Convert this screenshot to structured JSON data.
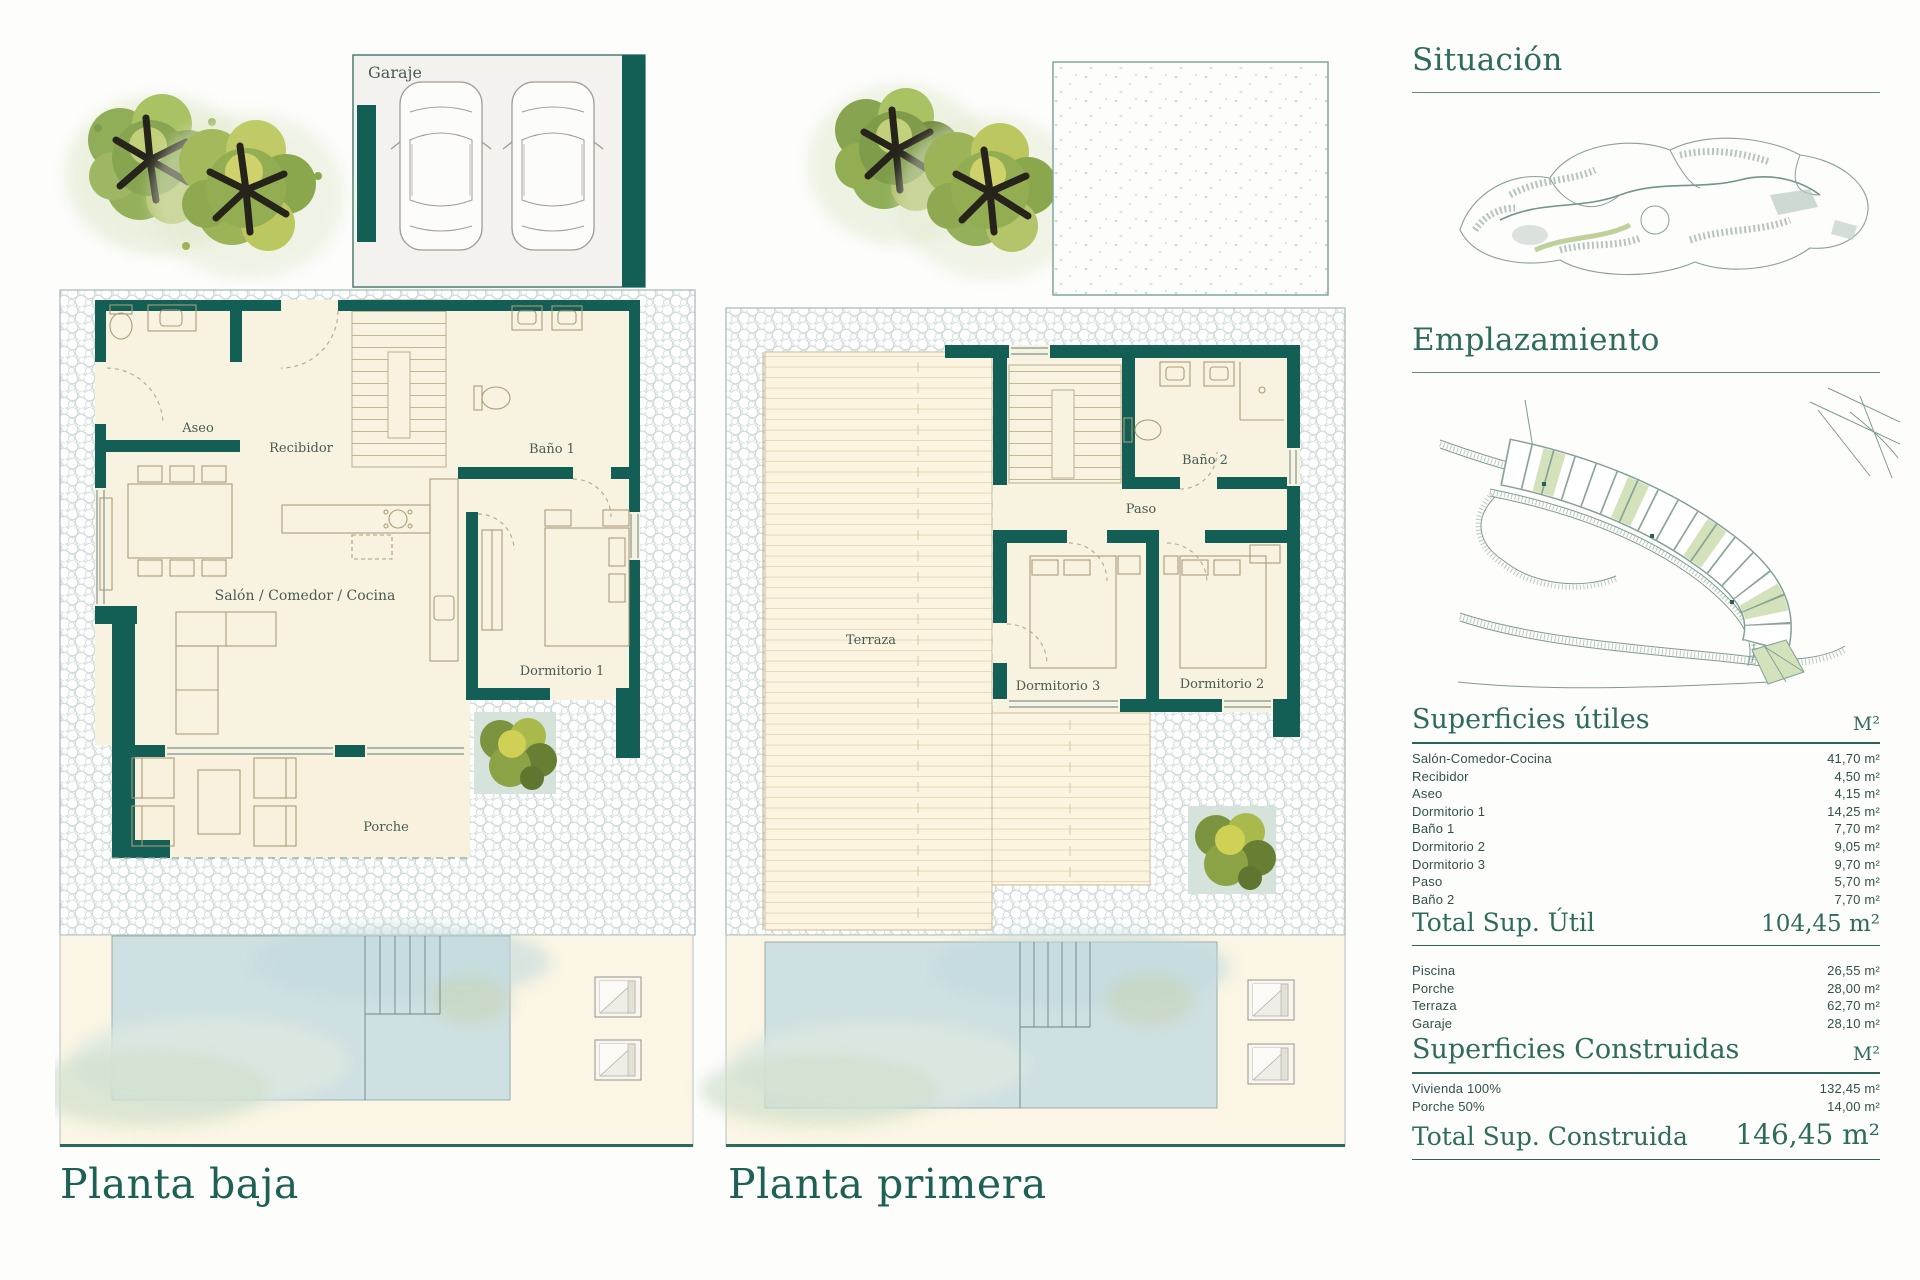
{
  "plan1": {
    "title": "Planta baja",
    "garaje": "Garaje",
    "aseo": "Aseo",
    "recibidor": "Recibidor",
    "bano1": "Baño 1",
    "salon": "Salón / Comedor / Cocina",
    "dormitorio1": "Dormitorio 1",
    "porche": "Porche"
  },
  "plan2": {
    "title": "Planta primera",
    "bano2": "Baño 2",
    "paso": "Paso",
    "terraza": "Terraza",
    "dormitorio3": "Dormitorio 3",
    "dormitorio2": "Dormitorio 2"
  },
  "sidebar": {
    "situacion_title": "Situación",
    "emplazamiento_title": "Emplazamiento",
    "superficies_utiles": {
      "title": "Superficies útiles",
      "unit": "M²",
      "rows": [
        {
          "label": "Salón-Comedor-Cocina",
          "value": "41,70 m²"
        },
        {
          "label": "Recibidor",
          "value": "4,50 m²"
        },
        {
          "label": "Aseo",
          "value": "4,15 m²"
        },
        {
          "label": "Dormitorio 1",
          "value": "14,25 m²"
        },
        {
          "label": "Baño 1",
          "value": "7,70 m²"
        },
        {
          "label": "Dormitorio 2",
          "value": "9,05 m²"
        },
        {
          "label": "Dormitorio 3",
          "value": "9,70 m²"
        },
        {
          "label": "Paso",
          "value": "5,70 m²"
        },
        {
          "label": "Baño 2",
          "value": "7,70 m²"
        }
      ],
      "total_label": "Total Sup. Útil",
      "total_value": "104,45 m²"
    },
    "exteriores_rows": [
      {
        "label": "Piscina",
        "value": "26,55 m²"
      },
      {
        "label": "Porche",
        "value": "28,00 m²"
      },
      {
        "label": "Terraza",
        "value": "62,70 m²"
      },
      {
        "label": "Garaje",
        "value": "28,10 m²"
      }
    ],
    "superficies_construidas": {
      "title": "Superficies Construidas",
      "unit": "M²",
      "rows": [
        {
          "label": "Vivienda 100%",
          "value": "132,45 m²"
        },
        {
          "label": "Porche 50%",
          "value": "14,00 m²"
        }
      ],
      "total_label": "Total Sup. Construida",
      "total_value": "146,45 m²"
    }
  },
  "colors": {
    "wall_teal": "#135e55",
    "title_teal": "#2f6b5d",
    "highlight_plot_green": "#d3e2bb",
    "pool_blue": "#cfe0e2",
    "room_cream": "#f8f3e1"
  }
}
